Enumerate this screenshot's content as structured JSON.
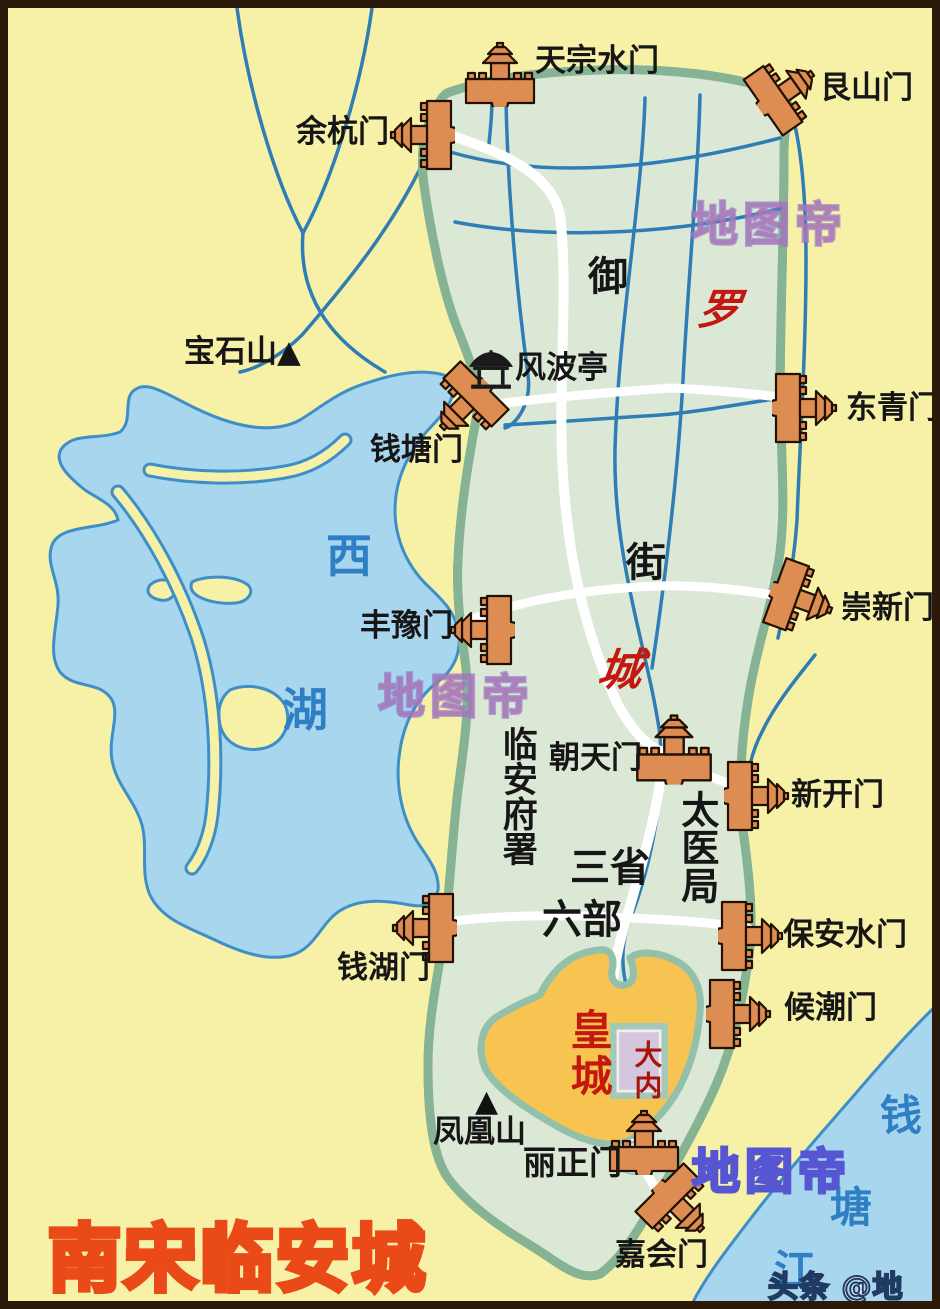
{
  "map": {
    "title": "南宋临安城",
    "watermark": "地图帝",
    "credit": "头条 @地图帝",
    "gates": {
      "tianzongshuimen": "天宗水门",
      "genshanmen": "艮山门",
      "yuhangmen": "余杭门",
      "qiantangmen": "钱塘门",
      "dongqingmen": "东青门",
      "fengyumen": "丰豫门",
      "chongxinmen": "崇新门",
      "chaotianmen": "朝天门",
      "xinkaimen": "新开门",
      "baoanshuimen": "保安水门",
      "qianhumen": "钱湖门",
      "houchaomen": "候潮门",
      "lizhengmen": "丽正门",
      "jiahuimen": "嘉会门"
    },
    "landmarks": {
      "fengboting": "风波亭",
      "baoshishan": "宝石山",
      "fenghuangshan": "凤凰山",
      "mountain_marker": "▲",
      "linanfushu": "临安府署",
      "taiyiju": "太医局",
      "sansheng": "三省",
      "liubu": "六部"
    },
    "districts": {
      "yu": "御",
      "jie": "街",
      "luo": "罗",
      "cheng": "城",
      "huangcheng": "皇城",
      "danei": "大内"
    },
    "water": {
      "xi": "西",
      "hu": "湖",
      "river_chars": [
        "钱",
        "塘",
        "江"
      ]
    },
    "colors": {
      "land_yellow": "#f7f1a8",
      "lake_blue": "#a8d6ef",
      "water_stroke": "#3e8fc7",
      "city_green": "#dbe8d5",
      "wall_green": "#85b394",
      "palace_orange": "#f7c451",
      "gate_orange": "#dd8c52",
      "canal_blue": "#2f7db5",
      "red_text": "#c2180f",
      "title_yellow": "#ffd93e",
      "title_outline": "#ea4a18"
    }
  }
}
